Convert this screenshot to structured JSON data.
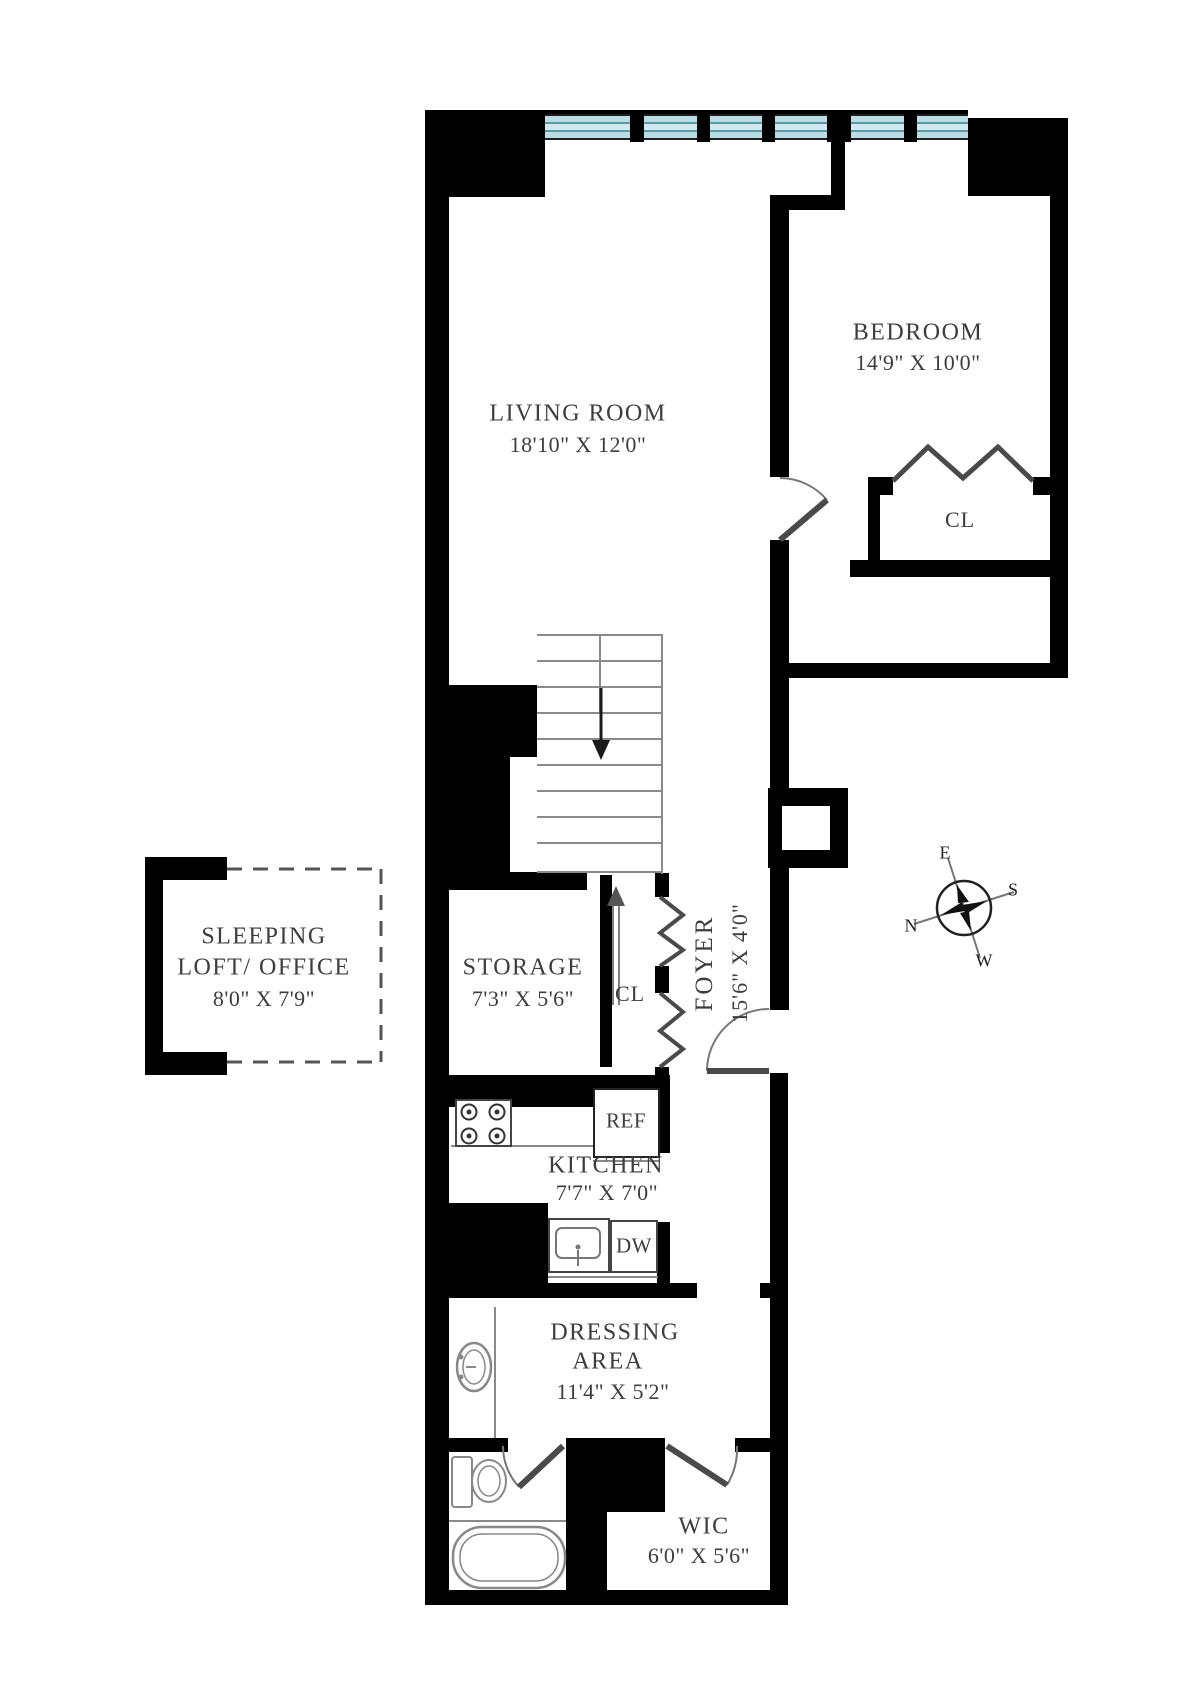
{
  "plan": {
    "rooms": {
      "living_room": {
        "name": "LIVING ROOM",
        "dims": "18'10\" X 12'0\""
      },
      "bedroom": {
        "name": "BEDROOM",
        "dims": "14'9\" X 10'0\""
      },
      "bedroom_closet": {
        "name": "CL"
      },
      "sleeping_loft": {
        "line1": "SLEEPING",
        "line2": "LOFT/ OFFICE",
        "dims": "8'0\" X 7'9\""
      },
      "storage": {
        "name": "STORAGE",
        "dims": "7'3\" X 5'6\""
      },
      "foyer": {
        "name": "FOYER",
        "dims": "15'6\" X 4'0\""
      },
      "foyer_closet": {
        "name": "CL"
      },
      "kitchen": {
        "name": "KITCHEN",
        "dims": "7'7\" X 7'0\""
      },
      "dressing_area": {
        "line1": "DRESSING",
        "line2": "AREA",
        "dims": "11'4\" X 5'2\""
      },
      "wic": {
        "name": "WIC",
        "dims": "6'0\" X 5'6\""
      }
    },
    "appliances": {
      "refrigerator": "REF",
      "dishwasher": "DW"
    },
    "compass": {
      "east": "E",
      "south": "S",
      "north": "N",
      "west": "W"
    },
    "colors": {
      "wall": "#000000",
      "window_fill": "#badde4",
      "window_line": "#579aa8",
      "text": "#3d3d3d"
    }
  }
}
